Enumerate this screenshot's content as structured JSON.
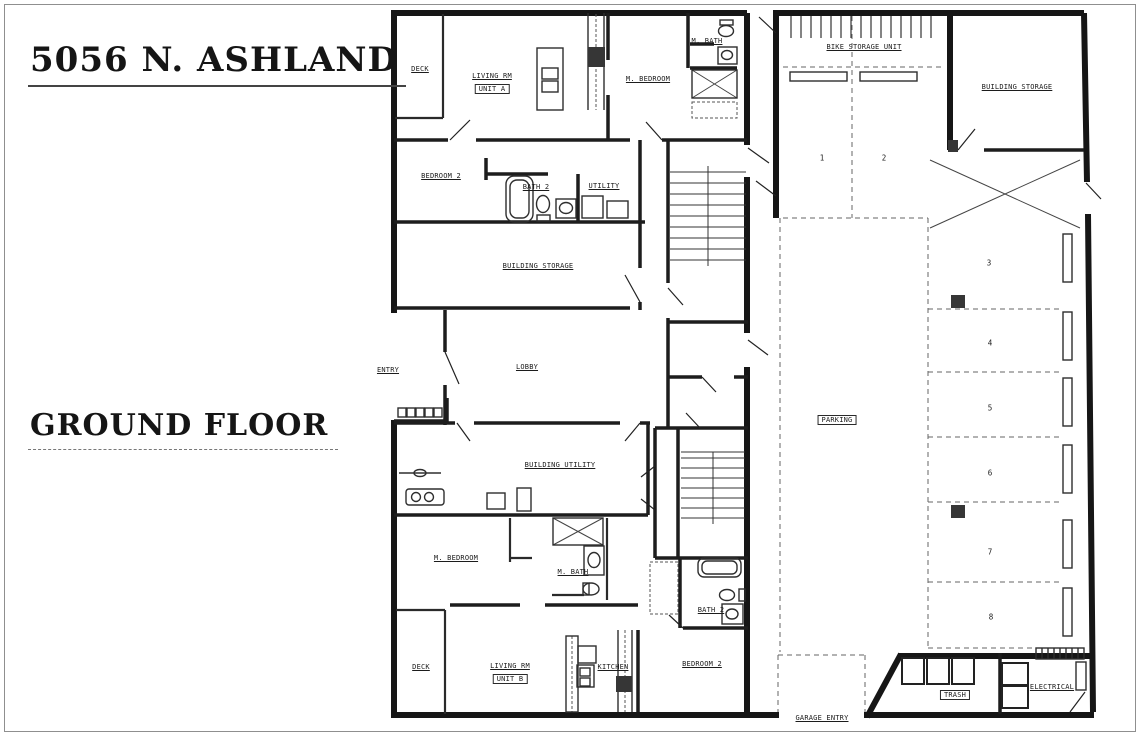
{
  "page": {
    "title": "5056 N. ASHLAND",
    "floor": "GROUND FLOOR"
  },
  "unit_a": {
    "name": "UNIT A",
    "deck": "DECK",
    "living": "LIVING RM",
    "m_bedroom": "M. BEDROOM",
    "m_bath": "M. BATH",
    "bedroom_2": "BEDROOM 2",
    "bath_2": "BATH 2",
    "utility": "UTILITY"
  },
  "unit_b": {
    "name": "UNIT B",
    "deck": "DECK",
    "living": "LIVING RM",
    "kitchen": "KITCHEN",
    "m_bedroom": "M. BEDROOM",
    "m_bath": "M. BATH",
    "bedroom_2": "BEDROOM 2",
    "bath_2": "BATH 2"
  },
  "common": {
    "entry": "ENTRY",
    "lobby": "LOBBY",
    "building_storage": "BUILDING STORAGE",
    "building_utility": "BUILDING UTILITY",
    "bike_storage": "BIKE STORAGE UNIT",
    "parking": "PARKING",
    "garage_entry": "GARAGE ENTRY",
    "trash": "TRASH",
    "electrical": "ELECTRICAL"
  },
  "parking_stalls": [
    "1",
    "2",
    "3",
    "4",
    "5",
    "6",
    "7",
    "8"
  ],
  "colors": {
    "ink": "#1a1a1a",
    "paper": "#ffffff",
    "dash": "#666666"
  }
}
